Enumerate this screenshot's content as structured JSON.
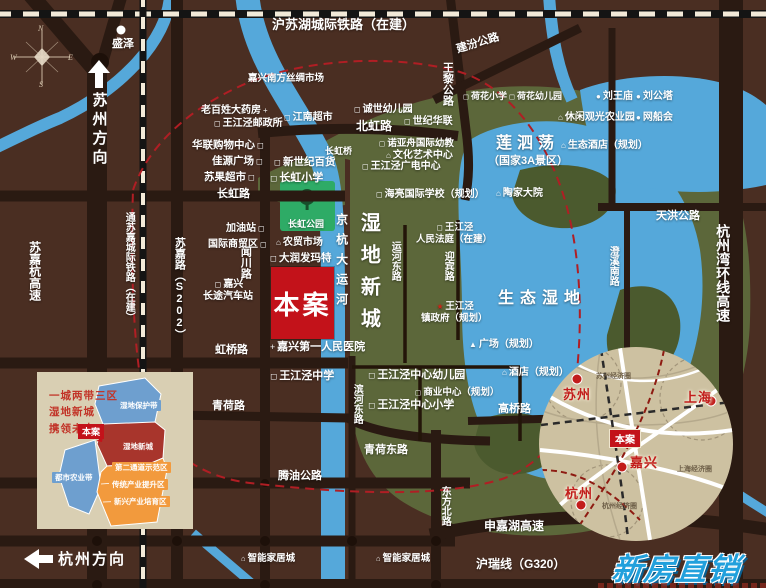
{
  "palette": {
    "background": "#4a2e22",
    "road": "#2a1a12",
    "water": "#55a8da",
    "wetland_green": "#5c673a",
    "wetland_dark": "#4b5a2e",
    "park_green": "#2eab66",
    "boundary_red": "#b01e24",
    "site_red": "#c3121a",
    "inset_beige": "#d9cfb3",
    "region_circle_tan": "#cdc1a1",
    "logo_blue": "#21a0dc"
  },
  "compass": {
    "n": "N",
    "w": "W",
    "e": "E",
    "s": "S"
  },
  "directions": {
    "suzhou": "苏州方向",
    "hangzhou": "杭州方向"
  },
  "site": {
    "label": "本案"
  },
  "logo": {
    "text": "新房直销"
  },
  "icon_glyphs": {
    "school": "◻",
    "house": "⌂",
    "dot": "●",
    "cross": "+",
    "triangle": "▲",
    "star": "★"
  },
  "labels": [
    {
      "id": "rail-hu-su-hu",
      "t": "沪苏湖城际铁路（在建）",
      "x": 272,
      "y": 17,
      "fs": 13
    },
    {
      "id": "shengze-town",
      "t": "盛泽",
      "x": 112,
      "y": 38,
      "fs": 11
    },
    {
      "id": "silk-market",
      "t": "嘉兴南方丝绸市场",
      "x": 248,
      "y": 73,
      "fs": 9.5
    },
    {
      "id": "pharmacy",
      "t": "老百姓大药房",
      "x": 201,
      "y": 105,
      "fs": 10,
      "ir": "cross"
    },
    {
      "id": "post-office",
      "t": "王江泾邮政所",
      "x": 212,
      "y": 118,
      "fs": 10,
      "icon": "school"
    },
    {
      "id": "jiangnan-supermarket",
      "t": "江南超市",
      "x": 282,
      "y": 112,
      "fs": 10,
      "icon": "school"
    },
    {
      "id": "hualian-mall",
      "t": "华联购物中心",
      "x": 192,
      "y": 139,
      "fs": 10.5,
      "ir": "school"
    },
    {
      "id": "jiayuan-plaza",
      "t": "佳源广场",
      "x": 212,
      "y": 155,
      "fs": 10.5,
      "ir": "school"
    },
    {
      "id": "suguo-supermarket",
      "t": "苏果超市",
      "x": 204,
      "y": 171,
      "fs": 10.5,
      "ir": "school"
    },
    {
      "id": "new-century-store",
      "t": "新世纪百货",
      "x": 272,
      "y": 156,
      "fs": 10.5,
      "icon": "school"
    },
    {
      "id": "changhong-primary",
      "t": "长虹小学",
      "x": 268,
      "y": 172,
      "fs": 11,
      "icon": "school"
    },
    {
      "id": "changhong-bridge",
      "t": "长虹桥",
      "x": 325,
      "y": 146,
      "fs": 9
    },
    {
      "id": "chengshi-kindergarten",
      "t": "诚世幼儿园",
      "x": 352,
      "y": 104,
      "fs": 10,
      "icon": "school"
    },
    {
      "id": "century-hualian",
      "t": "世纪华联",
      "x": 402,
      "y": 116,
      "fs": 10,
      "icon": "school"
    },
    {
      "id": "beihong-road",
      "t": "北虹路",
      "x": 356,
      "y": 119,
      "fs": 12
    },
    {
      "id": "wangli-highway",
      "t": "王黎公路",
      "x": 440,
      "y": 62,
      "fs": 11,
      "v": 1
    },
    {
      "id": "jianfen-highway",
      "t": "建汾公路",
      "x": 455,
      "y": 44,
      "fs": 11,
      "rot": -17
    },
    {
      "id": "hehua-primary",
      "t": "荷花小学",
      "x": 461,
      "y": 91,
      "fs": 9,
      "icon": "school"
    },
    {
      "id": "hehua-kindergarten",
      "t": "荷花幼儿园",
      "x": 507,
      "y": 91,
      "fs": 9,
      "icon": "school"
    },
    {
      "id": "liuwang-temple",
      "t": "刘王庙",
      "x": 594,
      "y": 91,
      "fs": 10,
      "icon": "dot"
    },
    {
      "id": "liugong-tower",
      "t": "刘公塔",
      "x": 634,
      "y": 91,
      "fs": 10,
      "icon": "dot"
    },
    {
      "id": "leisure-sightseeing-farm",
      "t": "休闲观光农业园",
      "x": 556,
      "y": 112,
      "fs": 10,
      "icon": "house"
    },
    {
      "id": "wangchuan-fair",
      "t": "网船会",
      "x": 634,
      "y": 112,
      "fs": 10,
      "icon": "dot"
    },
    {
      "id": "eco-hotel-planned",
      "t": "生态酒店（规划）",
      "x": 559,
      "y": 140,
      "fs": 10,
      "icon": "house"
    },
    {
      "id": "liansidang-lake",
      "t": "莲泗荡",
      "x": 496,
      "y": 134,
      "fs": 16,
      "ls": 5
    },
    {
      "id": "liansidang-subtitle",
      "t": "（国家3A景区）",
      "x": 488,
      "y": 155,
      "fs": 11
    },
    {
      "id": "taojia-courtyard",
      "t": "陶家大院",
      "x": 494,
      "y": 188,
      "fs": 10,
      "icon": "house"
    },
    {
      "id": "tianhong-highway",
      "t": "天洪公路",
      "x": 656,
      "y": 210,
      "fs": 11
    },
    {
      "id": "chengxi-south-road",
      "t": "澄溪南路",
      "x": 606,
      "y": 246,
      "fs": 10,
      "v": 1
    },
    {
      "id": "hangzhouwan-ring-expressway",
      "t": "杭州湾环线高速",
      "x": 714,
      "y": 224,
      "fs": 14,
      "v": 1
    },
    {
      "id": "changhong-road",
      "t": "长虹路",
      "x": 217,
      "y": 188,
      "fs": 11
    },
    {
      "id": "changhong-park",
      "t": "长虹公园",
      "x": 288,
      "y": 219,
      "fs": 9
    },
    {
      "id": "gas-station",
      "t": "加油站",
      "x": 226,
      "y": 223,
      "fs": 10,
      "ir": "school"
    },
    {
      "id": "intl-trade-zone",
      "t": "国际商贸区",
      "x": 208,
      "y": 239,
      "fs": 10,
      "ir": "school"
    },
    {
      "id": "wenchuan-road",
      "t": "闻川路",
      "x": 238,
      "y": 246,
      "fs": 11,
      "v": 1
    },
    {
      "id": "longdistance-bus-station",
      "t": "嘉兴\n长途汽车站",
      "x": 203,
      "y": 279,
      "fs": 10,
      "ml": 1,
      "icon": "school"
    },
    {
      "id": "farmers-market",
      "t": "农贸市场",
      "x": 274,
      "y": 237,
      "fs": 10,
      "icon": "house"
    },
    {
      "id": "rt-mart",
      "t": "大润发玛特",
      "x": 268,
      "y": 252,
      "fs": 10.5,
      "icon": "school"
    },
    {
      "id": "noahs-ark-kindergarten",
      "t": "诺亚舟国际幼教",
      "x": 377,
      "y": 138,
      "fs": 9.5,
      "icon": "school"
    },
    {
      "id": "culture-art-center",
      "t": "文化艺术中心",
      "x": 384,
      "y": 150,
      "fs": 10,
      "icon": "house"
    },
    {
      "id": "broadcast-center",
      "t": "王江泾广电中心",
      "x": 360,
      "y": 161,
      "fs": 10,
      "icon": "school"
    },
    {
      "id": "hailiang-intl-school",
      "t": "海亮国际学校（规划）",
      "x": 374,
      "y": 189,
      "fs": 10,
      "icon": "school"
    },
    {
      "id": "first-peoples-hospital",
      "t": "嘉兴第一人民医院",
      "x": 268,
      "y": 341,
      "fs": 11,
      "icon": "cross"
    },
    {
      "id": "hongqiao-road",
      "t": "虹桥路",
      "x": 215,
      "y": 344,
      "fs": 11
    },
    {
      "id": "grand-canal",
      "t": "京杭大运河",
      "x": 334,
      "y": 213,
      "fs": 12,
      "v": 1,
      "ls": 8
    },
    {
      "id": "wetland-new-city",
      "t": "湿地新城",
      "x": 356,
      "y": 212,
      "fs": 20,
      "v": 1,
      "ls": 12
    },
    {
      "id": "yunhe-east-road",
      "t": "运河东路",
      "x": 388,
      "y": 241,
      "fs": 10,
      "v": 1
    },
    {
      "id": "peoples-court",
      "t": "王江泾\n人民法庭（在建）",
      "x": 416,
      "y": 222,
      "fs": 9.5,
      "ml": 1,
      "icon": "school"
    },
    {
      "id": "yingbin-road",
      "t": "迎宾路",
      "x": 441,
      "y": 251,
      "fs": 10,
      "v": 1
    },
    {
      "id": "town-government",
      "t": "王江泾\n镇政府（规划）",
      "x": 421,
      "y": 301,
      "fs": 9.5,
      "ml": 1,
      "icon": "star",
      "iconColor": "#d62015"
    },
    {
      "id": "plaza-planned",
      "t": "广场（规划）",
      "x": 467,
      "y": 339,
      "fs": 10,
      "icon": "triangle"
    },
    {
      "id": "eco-wetland",
      "t": "生态湿地",
      "x": 498,
      "y": 289,
      "fs": 16,
      "ls": 6
    },
    {
      "id": "hotel-planned",
      "t": "酒店（规划）",
      "x": 500,
      "y": 367,
      "fs": 10,
      "icon": "house"
    },
    {
      "id": "wjj-middle-school",
      "t": "王江泾中学",
      "x": 268,
      "y": 370,
      "fs": 11,
      "icon": "school"
    },
    {
      "id": "binhe-east-road",
      "t": "滨河东路",
      "x": 350,
      "y": 384,
      "fs": 10,
      "v": 1
    },
    {
      "id": "center-kindergarten",
      "t": "王江泾中心幼儿园",
      "x": 366,
      "y": 369,
      "fs": 11,
      "icon": "school"
    },
    {
      "id": "business-center-planned",
      "t": "商业中心（规划）",
      "x": 413,
      "y": 387,
      "fs": 9.5,
      "icon": "school"
    },
    {
      "id": "center-primary",
      "t": "王江泾中心小学",
      "x": 366,
      "y": 399,
      "fs": 11,
      "icon": "school"
    },
    {
      "id": "qinghe-east-road",
      "t": "青荷东路",
      "x": 364,
      "y": 444,
      "fs": 11
    },
    {
      "id": "qinghe-road",
      "t": "青荷路",
      "x": 212,
      "y": 400,
      "fs": 11
    },
    {
      "id": "tengyou-highway",
      "t": "腾油公路",
      "x": 278,
      "y": 470,
      "fs": 11
    },
    {
      "id": "dongfang-north-road",
      "t": "东方北路",
      "x": 438,
      "y": 486,
      "fs": 10,
      "v": 1
    },
    {
      "id": "gaoqiao-road",
      "t": "高桥路",
      "x": 498,
      "y": 403,
      "fs": 11
    },
    {
      "id": "shenjiahu-expressway",
      "t": "申嘉湖高速",
      "x": 484,
      "y": 519,
      "fs": 12
    },
    {
      "id": "hurui-line-g320",
      "t": "沪瑞线（G320）",
      "x": 476,
      "y": 557,
      "fs": 12
    },
    {
      "id": "smart-home-city-1",
      "t": "智能家居城",
      "x": 239,
      "y": 553,
      "fs": 9.5,
      "icon": "house"
    },
    {
      "id": "smart-home-city-2",
      "t": "智能家居城",
      "x": 374,
      "y": 553,
      "fs": 9.5,
      "icon": "house"
    },
    {
      "id": "sujia-road-s202",
      "t": "苏嘉路（S202）",
      "x": 172,
      "y": 237,
      "fs": 11,
      "v": 1
    },
    {
      "id": "tongsujia-railway",
      "t": "通苏嘉城际铁路（在建）",
      "x": 122,
      "y": 212,
      "fs": 10,
      "v": 1
    },
    {
      "id": "sujiahang-expressway",
      "t": "苏嘉杭高速",
      "x": 27,
      "y": 241,
      "fs": 12,
      "v": 1
    }
  ],
  "inset_plan": {
    "title": "一城两带三区\n湿地新城\n携领未来",
    "site_tag": "本案",
    "region_labels": [
      {
        "text": "湿地保护带",
        "bg": "blue",
        "x": 117,
        "y": 400
      },
      {
        "text": "湿地新城",
        "bg": "red",
        "x": 120,
        "y": 441
      },
      {
        "text": "第二通道示范区",
        "bg": "orange",
        "x": 112,
        "y": 462
      },
      {
        "text": "传统产业提升区",
        "bg": "orange",
        "x": 109,
        "y": 479
      },
      {
        "text": "新兴产业培育区",
        "bg": "orange",
        "x": 111,
        "y": 496
      },
      {
        "text": "都市农业带",
        "bg": "blue",
        "x": 52,
        "y": 472
      }
    ]
  },
  "inset_region": {
    "site_tag": "本案",
    "cities": [
      {
        "name": "苏州",
        "x": 563,
        "y": 384
      },
      {
        "name": "上海",
        "x": 684,
        "y": 387
      },
      {
        "name": "杭州",
        "x": 565,
        "y": 483
      },
      {
        "name": "嘉兴",
        "x": 630,
        "y": 452
      }
    ],
    "econ_circles": [
      {
        "text": "苏州经济圈",
        "x": 596,
        "y": 371
      },
      {
        "text": "上海经济圈",
        "x": 677,
        "y": 464
      },
      {
        "text": "杭州经济圈",
        "x": 602,
        "y": 501
      }
    ]
  }
}
